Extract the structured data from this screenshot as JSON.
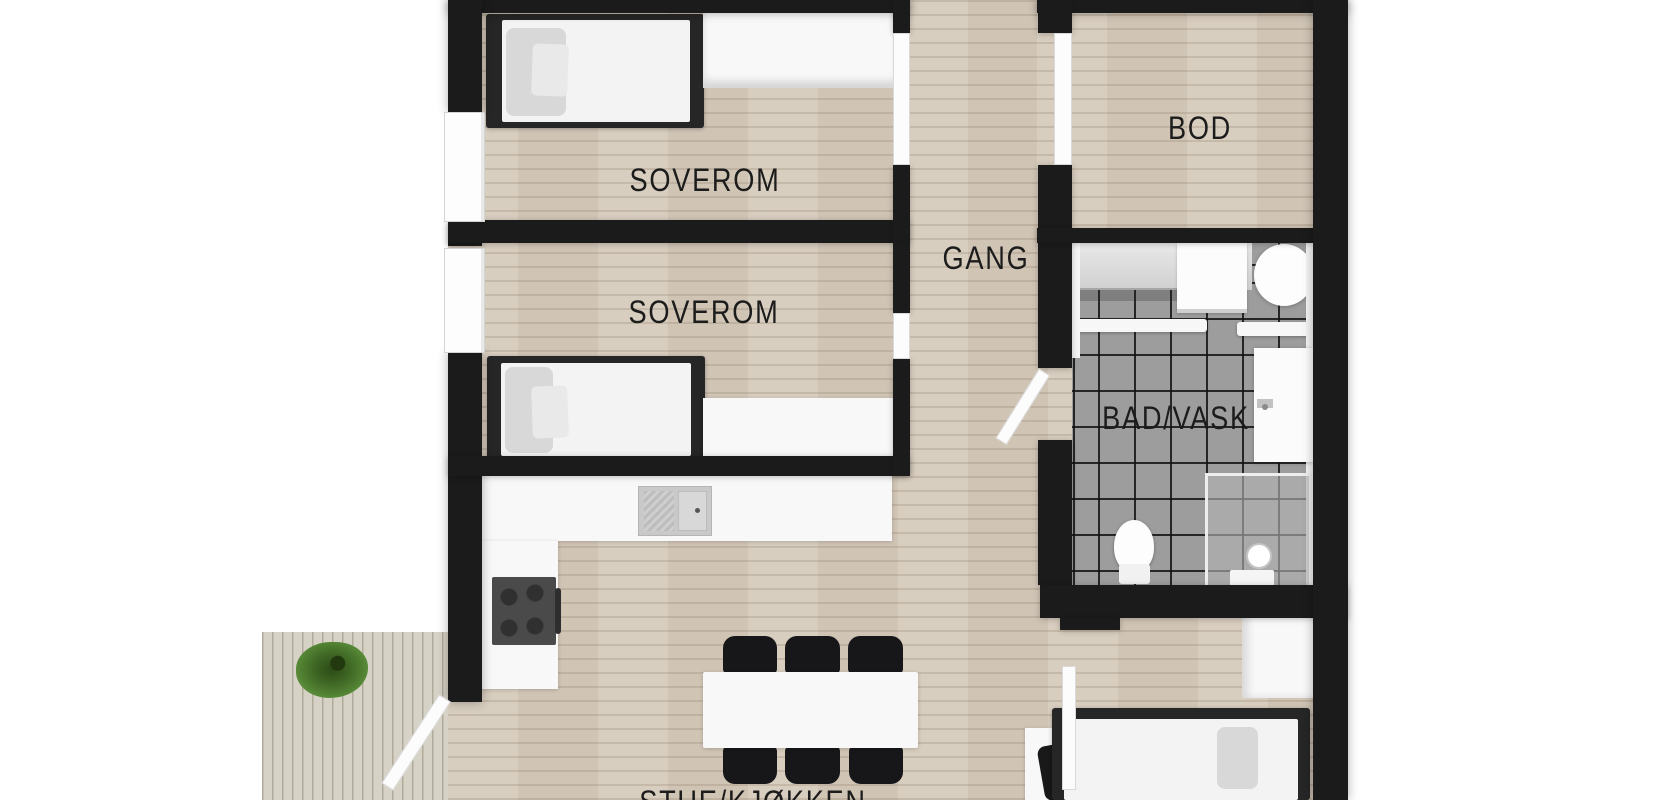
{
  "rooms": {
    "bedroom_top": {
      "label": "SOVEROM"
    },
    "bedroom_mid": {
      "label": "SOVEROM"
    },
    "hallway": {
      "label": "GANG"
    },
    "storage": {
      "label": "BOD"
    },
    "bathroom": {
      "label": "BAD/VASK"
    },
    "living_kitchen": {
      "label": "STUE/KJØKKEN"
    }
  },
  "colors": {
    "wall": "#1b1b1b",
    "wood": "#d6cbbc",
    "deck": "#d7d2c6",
    "tile": "#9d9d9d",
    "white-f": "#f8f8f8",
    "dark-f": "#262626",
    "chair": "#17171a",
    "stove": "#4a4a4a",
    "plant": "#4e7d30",
    "text": "#1c1c1c"
  }
}
